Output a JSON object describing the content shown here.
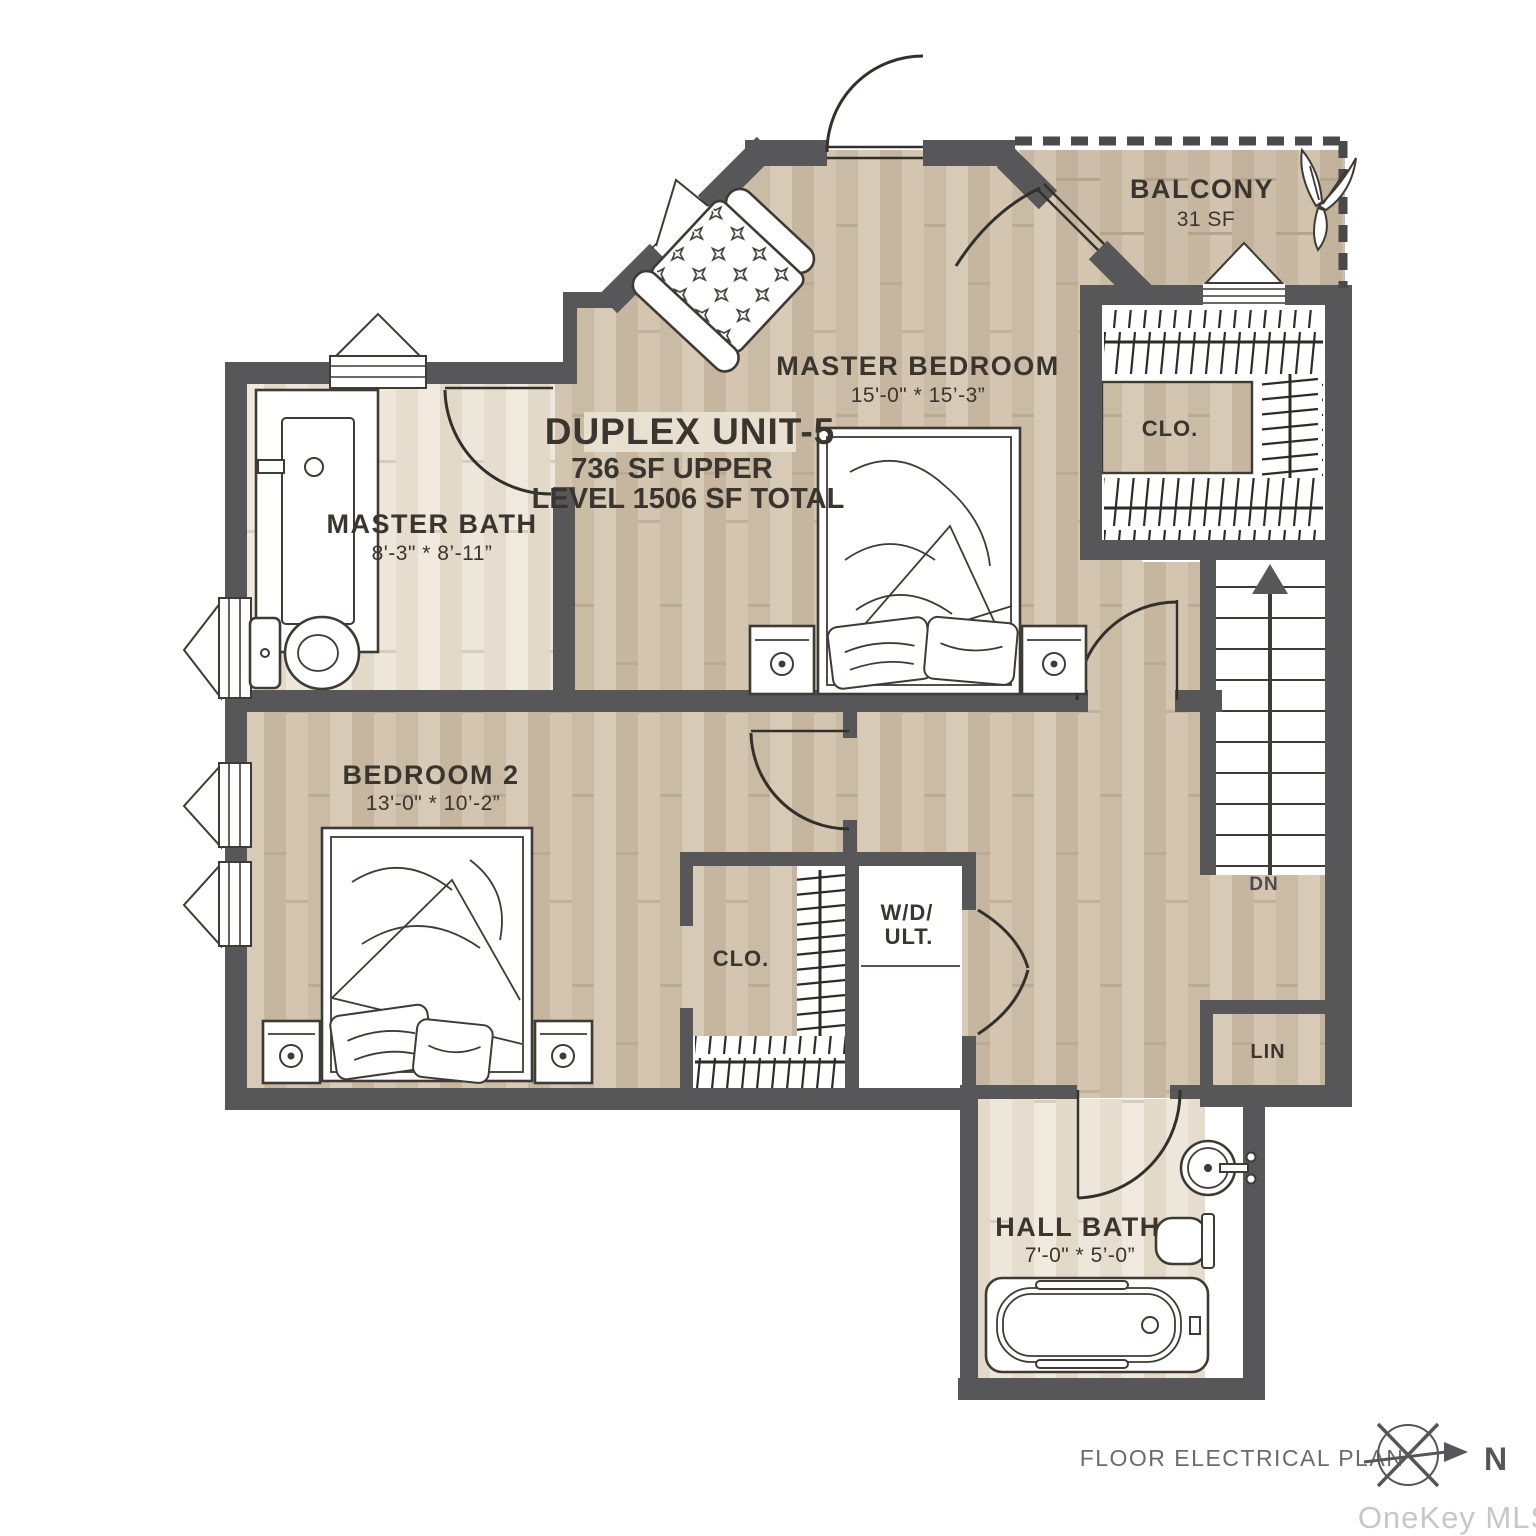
{
  "unit": {
    "title": "DUPLEX UNIT-5",
    "area_line1": "736 SF UPPER",
    "area_line2": "LEVEL 1506 SF TOTAL"
  },
  "rooms": {
    "balcony": {
      "name": "BALCONY",
      "area": "31 SF"
    },
    "master_bedroom": {
      "name": "MASTER BEDROOM",
      "dims": "15'-0\" * 15’-3”"
    },
    "master_bath": {
      "name": "MASTER BATH",
      "dims": "8'-3\" * 8’-11”"
    },
    "bedroom_2": {
      "name": "BEDROOM 2",
      "dims": "13'-0\" * 10’-2”"
    },
    "hall_bath": {
      "name": "HALL BATH",
      "dims": "7'-0\" * 5’-0”"
    },
    "walk_in_closet": {
      "name": "CLO."
    },
    "bedroom_2_closet": {
      "name": "CLO."
    },
    "linen_closet": {
      "name": "LIN"
    },
    "laundry": {
      "line1": "W/D/",
      "line2": "ULT."
    },
    "stairs": {
      "label": "DN"
    }
  },
  "footer": {
    "plan_label": "FLOOR ELECTRICAL PLAN",
    "compass_label": "N"
  },
  "watermark": "OneKey MLS",
  "colors": {
    "wall": "#57575a",
    "floor_tan": "#cfc1ac",
    "floor_light": "#eae3d6",
    "floor_balcony": "#c9b9a3",
    "label_text": "#3a352e",
    "footer_text": "#6b6b6b",
    "watermark_text": "#c7c7c7"
  }
}
